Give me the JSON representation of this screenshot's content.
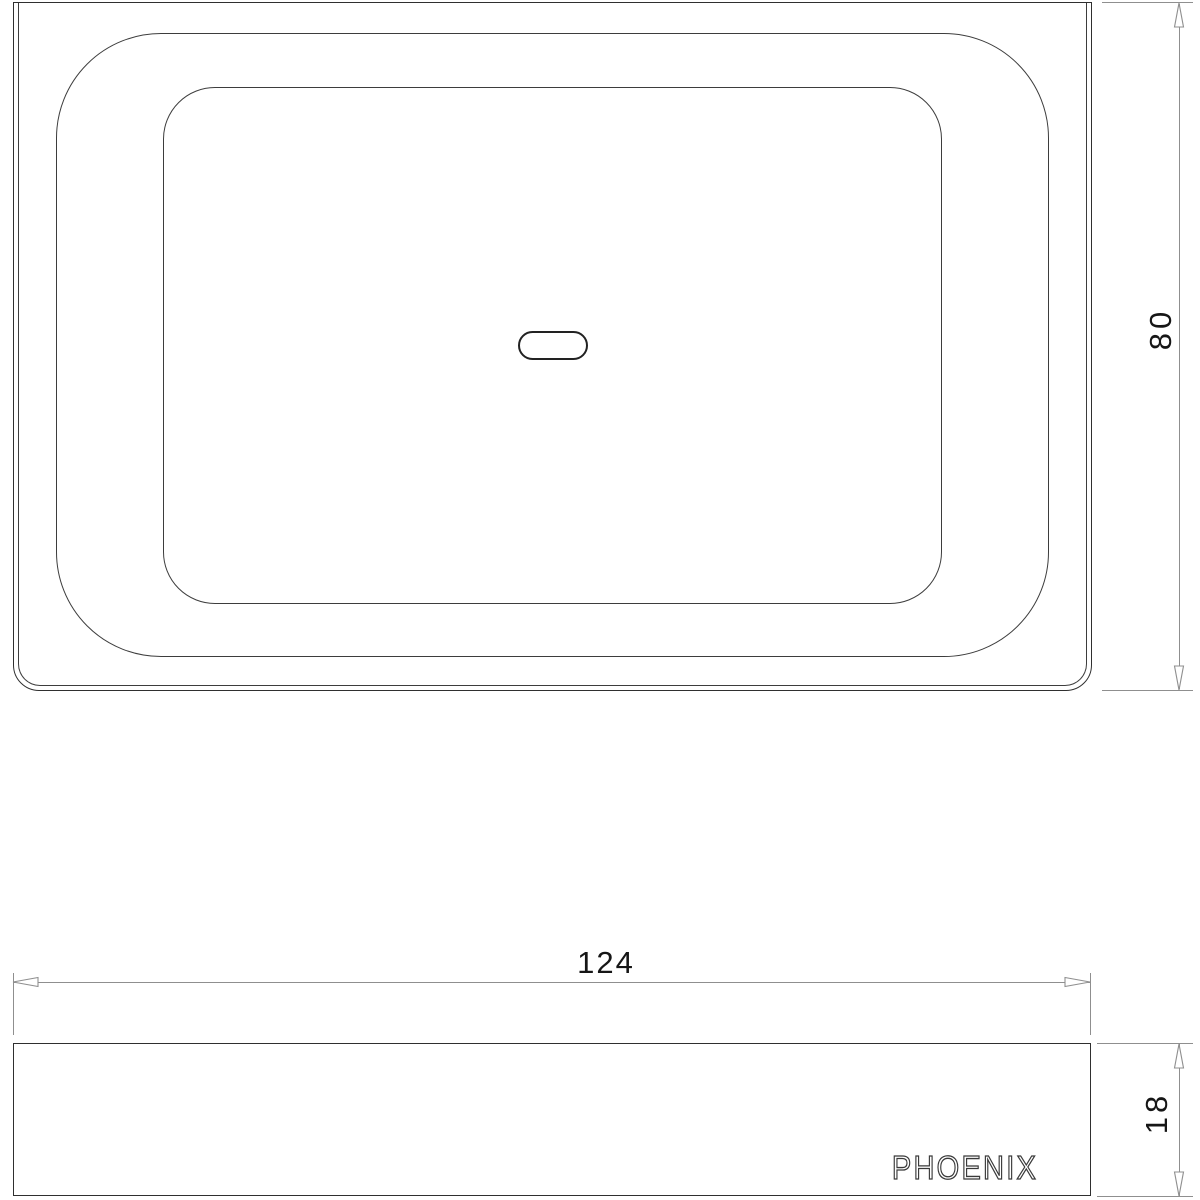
{
  "colors": {
    "line_strong": "#2f2f2f",
    "line_thin": "#3d3d3d",
    "dim_line": "#8f8f8f",
    "dim_text": "#161616",
    "logo_stroke": "#3a3a3a",
    "background": "#ffffff"
  },
  "dimensions": {
    "width": {
      "label": "124",
      "value": 124
    },
    "height": {
      "label": "80",
      "value": 80
    },
    "depth": {
      "label": "18",
      "value": 18
    }
  },
  "branding": {
    "logo_text": "PHOENIX"
  }
}
